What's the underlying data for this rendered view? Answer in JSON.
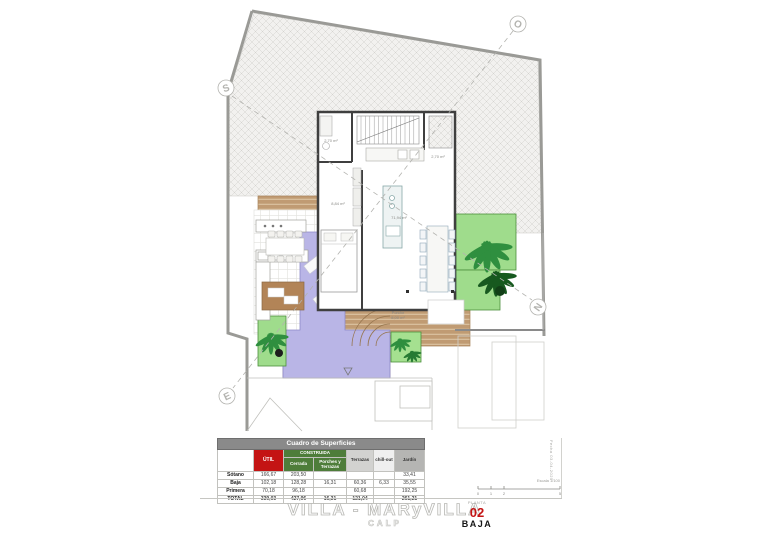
{
  "plan": {
    "compass": {
      "s": "S",
      "o": "O",
      "n": "N",
      "e": "E"
    },
    "labels": {
      "room_small_left": "2,70 m²",
      "room_small_right": "2,70 m²",
      "bedroom": "8,84 m²",
      "living": "71,94 m²",
      "porch_line1": "Porche",
      "porch_line2": "8,00 m²"
    },
    "colors": {
      "hatch_bg": "#f2f1ef",
      "deck": "#c09b73",
      "pool": "#b9b5e6",
      "planter": "#9fdc8c",
      "wall": "#3f3f3f"
    }
  },
  "table": {
    "title": "Cuadro de Superficies",
    "headers": {
      "util": "ÚTIL",
      "construida": "CONSTRUIDA",
      "cerrada": "Cerrada",
      "porches": "Porches y Terrazas",
      "terrazas": "Terrazas",
      "chillout": "chill-out",
      "jardin": "Jardín"
    },
    "header_colors": {
      "util": "#c41414",
      "construida": "#4e7d3a",
      "title_bar": "#8a8a8a"
    },
    "rows": [
      {
        "label": "Sótano",
        "util": "166,67",
        "cerrada": "203,50",
        "porches": "",
        "terrazas": "",
        "chillout": "",
        "jardin": "33,41"
      },
      {
        "label": "Baja",
        "util": "102,18",
        "cerrada": "128,28",
        "porches": "16,31",
        "terrazas": "60,36",
        "chillout": "6,33",
        "jardin": "35,55"
      },
      {
        "label": "Primera",
        "util": "70,18",
        "cerrada": "96,18",
        "porches": "",
        "terrazas": "60,68",
        "chillout": "",
        "jardin": "192,25"
      },
      {
        "label": "TOTAL",
        "util": "339,03",
        "cerrada": "427,96",
        "porches": "16,31",
        "terrazas": "121,04",
        "chillout": "",
        "jardin": "261,21"
      }
    ]
  },
  "footer": {
    "project_title": "VILLA - MARyVILLA",
    "location": "CALP",
    "sheet_label": "PLANTA",
    "sheet_number": "02",
    "sheet_name": "BAJA",
    "scale_label": "Escala 1/100",
    "date_label": "Fecha 03-04-2025",
    "scale_ticks": [
      "0",
      "1",
      "2",
      "5"
    ]
  }
}
